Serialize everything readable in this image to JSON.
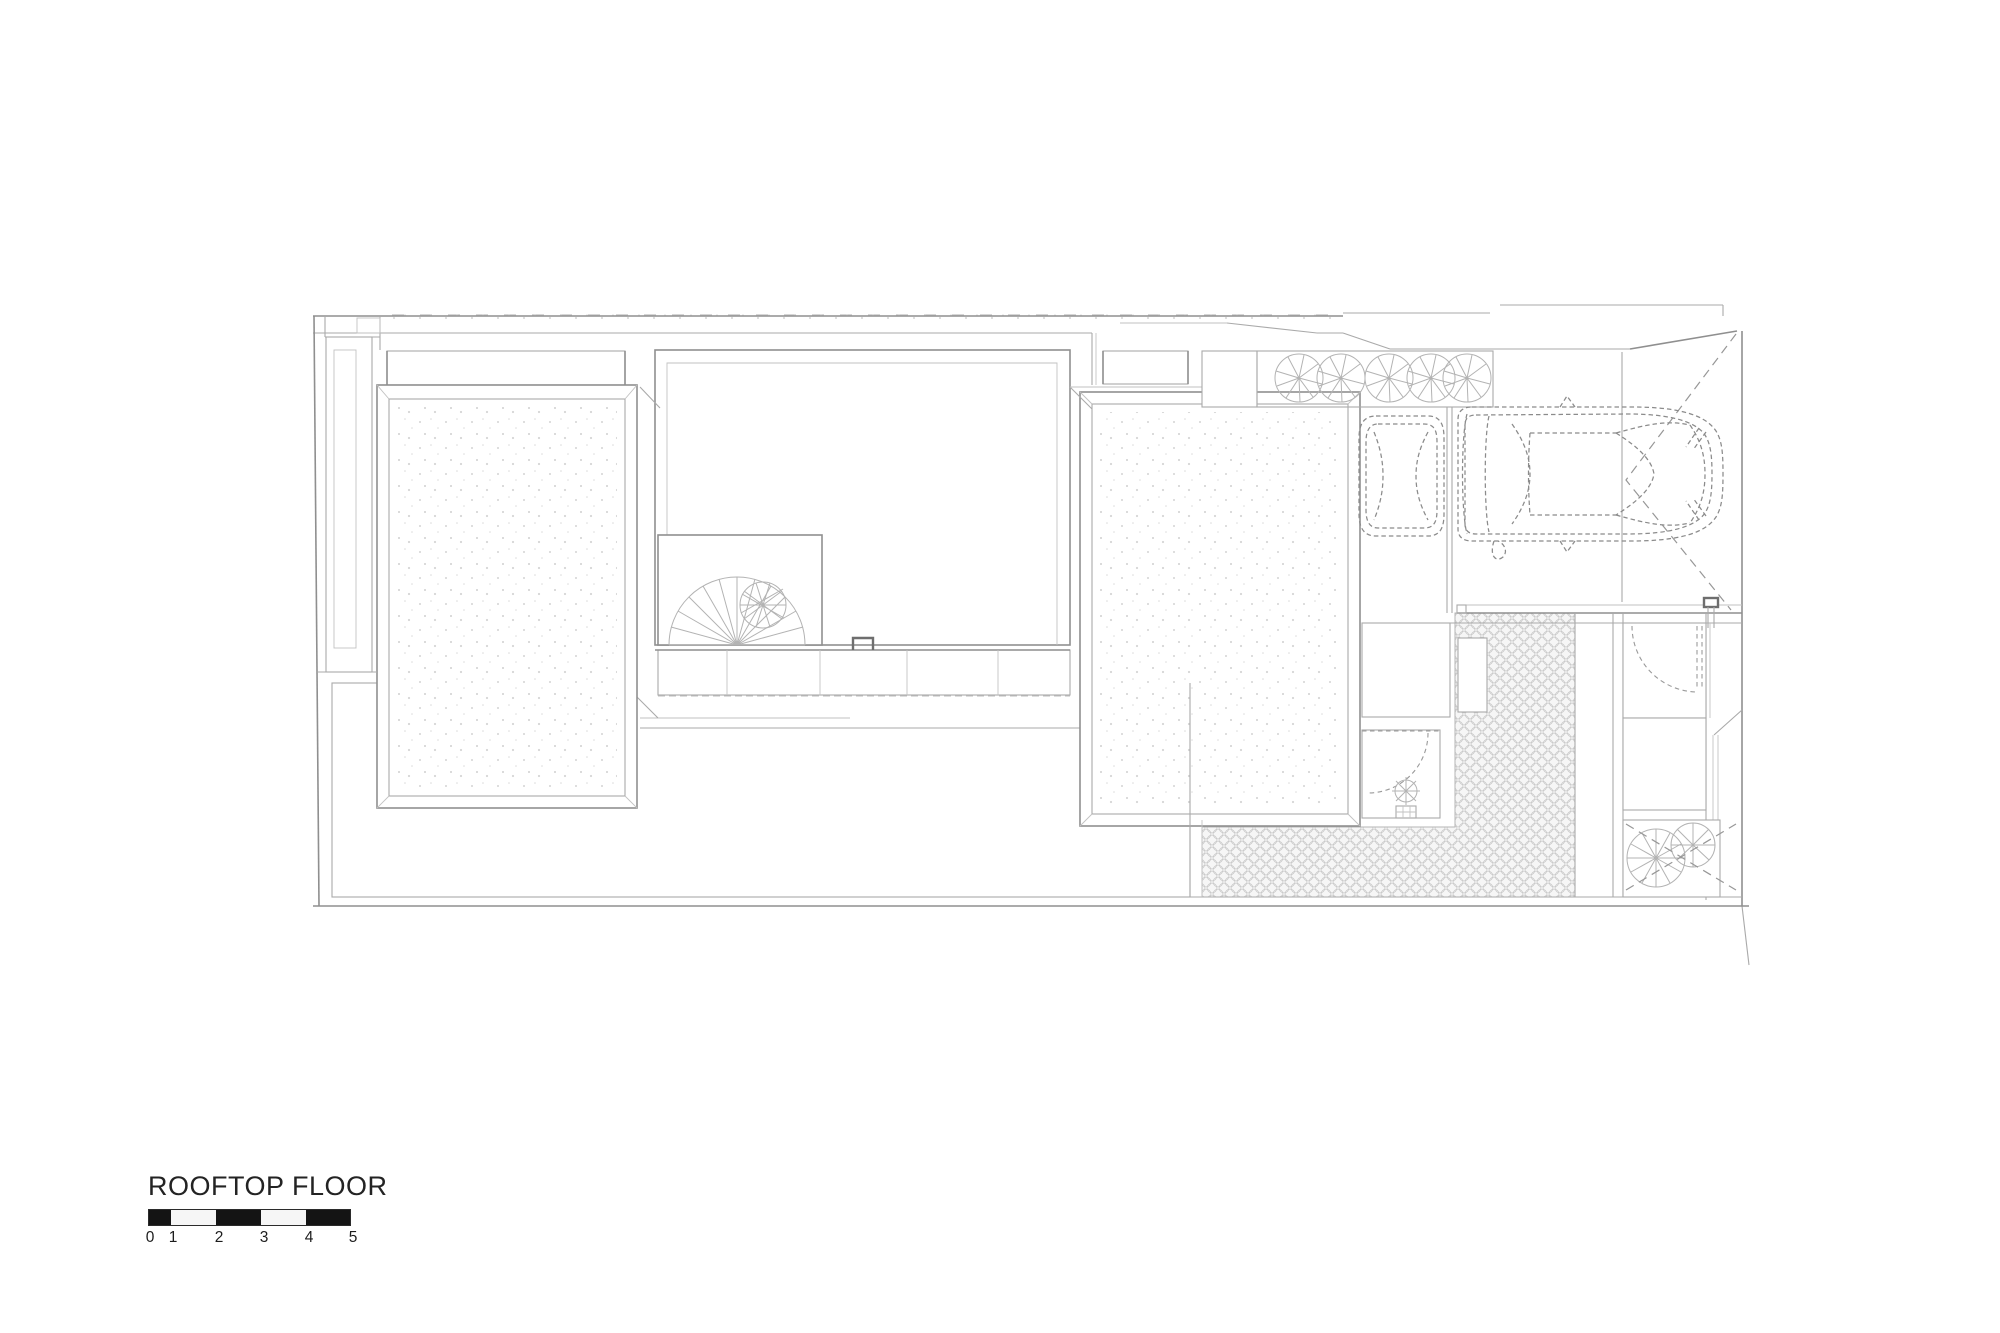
{
  "title_block": {
    "title": "ROOFTOP FLOOR"
  },
  "scale_bar": {
    "labels": [
      "0",
      "1",
      "2",
      "3",
      "4",
      "5"
    ],
    "units_shown": 5,
    "bar_color": "#141414",
    "border_color": "#2b2b2b"
  },
  "drawing": {
    "background": "#ffffff",
    "main_line_color": "#8f8f8f",
    "light_line_color": "#aaaaaa",
    "hatch_line_color": "#c2c2c2",
    "dashed_line_color": "#979797",
    "icons": {
      "car": "car-top-view-icon",
      "small_car": "compact-car-top-view-icon",
      "tree": "tree-canopy-icon",
      "plant": "potted-plant-icon",
      "spiral_stair": "spiral-stair-icon",
      "fan_stair": "spiral-stair-fan-icon",
      "door": "door-swing-arc-icon",
      "hatch_handle": "roof-hatch-handle-icon"
    }
  }
}
